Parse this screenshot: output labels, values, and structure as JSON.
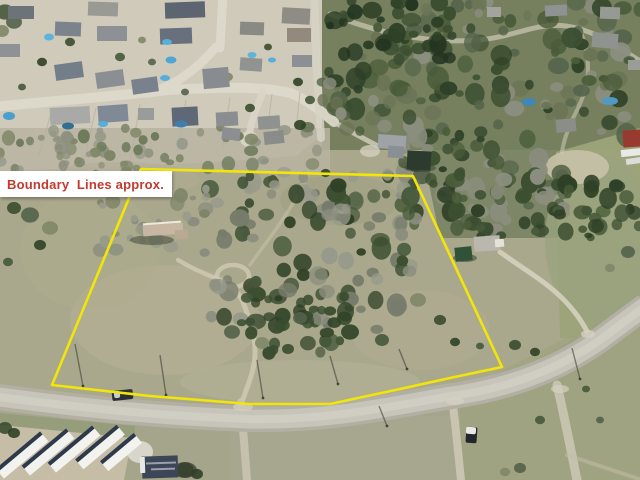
{
  "annotation": {
    "label": "Boundary  Lines approx.",
    "text_color": "#c43a2f",
    "bg_color": "#ffffff"
  },
  "boundary": {
    "color": "#f2e50a",
    "width": 2.6,
    "points": "141,169 413,176 502,367 450,378 400,389 330,404 250,404 150,396 52,385"
  },
  "scene": {
    "bases": [
      {
        "type": "rect",
        "x": 0,
        "y": 0,
        "w": 640,
        "h": 480,
        "f": "#aaa88c"
      },
      {
        "type": "poly",
        "pts": "0,0 322,0 322,135 296,156 200,163 80,168 0,171",
        "f": "#cfcaba"
      },
      {
        "type": "rect",
        "x": 322,
        "y": 0,
        "w": 318,
        "h": 150,
        "f": "#76805f"
      },
      {
        "type": "poly",
        "pts": "420,140 570,140 570,238 440,238",
        "f": "#76805f",
        "o": 0.85
      },
      {
        "type": "poly",
        "pts": "556,152 640,128 640,338 560,338",
        "f": "#9ca379",
        "o": 0.95
      },
      {
        "type": "poly",
        "pts": "0,412 240,428 460,402 640,302 640,480 0,480",
        "f": "#a5a58c"
      },
      {
        "type": "rect",
        "x": 0,
        "y": 128,
        "w": 330,
        "h": 44,
        "f": "#b8b4a0",
        "o": 0.85
      },
      {
        "type": "poly",
        "pts": "230,416 460,416 460,480 230,480",
        "f": "#a8a791",
        "o": 0.6
      },
      {
        "type": "poly",
        "pts": "460,392 640,300 640,480 460,480",
        "f": "#9ba279",
        "o": 0.55
      },
      {
        "type": "poly",
        "pts": "0,413 135,426 135,438 0,425",
        "f": "#959c79",
        "o": 0.9
      },
      {
        "type": "poly",
        "pts": "0,425 132,438 124,480 0,480",
        "f": "#c5bda6"
      }
    ],
    "patches": [
      {
        "cx": 165,
        "cy": 320,
        "rx": 95,
        "ry": 55,
        "f": "#b6b298",
        "o": 0.5
      },
      {
        "cx": 420,
        "cy": 330,
        "rx": 70,
        "ry": 40,
        "f": "#b2ae92",
        "o": 0.45
      },
      {
        "cx": 300,
        "cy": 382,
        "rx": 120,
        "ry": 22,
        "f": "#b6b39a",
        "o": 0.4
      },
      {
        "cx": 90,
        "cy": 250,
        "rx": 70,
        "ry": 60,
        "f": "#aeab8c",
        "o": 0.5
      },
      {
        "cx": 600,
        "cy": 240,
        "rx": 55,
        "ry": 85,
        "f": "#9aa37e",
        "o": 0.8
      },
      {
        "cx": 577,
        "cy": 167,
        "rx": 32,
        "ry": 17,
        "f": "#c8c2a8",
        "o": 0.9
      },
      {
        "cx": 340,
        "cy": 200,
        "rx": 60,
        "ry": 25,
        "f": "#9a9a80",
        "o": 0.4
      },
      {
        "cx": 120,
        "cy": 180,
        "rx": 80,
        "ry": 18,
        "f": "#b0ac94",
        "o": 0.5
      }
    ],
    "streets": [
      {
        "d": "M -6 107 C 60 100 120 96 168 90 C 225 87 262 86 290 93 C 306 99 320 110 334 122",
        "w": 10,
        "c": "#dcd8ca",
        "o": 0.95
      },
      {
        "d": "M 150 93 C 178 84 200 66 216 47",
        "w": 9,
        "c": "#dcd8ca",
        "o": 0.95
      },
      {
        "d": "M 220 48 L 223 -6",
        "w": 9,
        "c": "#dcd8ca",
        "o": 0.95
      },
      {
        "d": "M 263 91 C 258 106 252 116 250 131",
        "w": 7,
        "c": "#d9d5c7",
        "o": 0.9
      },
      {
        "d": "M 314 -6 L 317 70 L 321 138",
        "w": 8,
        "c": "#d6d2c4",
        "o": 0.85
      },
      {
        "d": "M 330 14 C 380 34 432 44 478 40 C 515 37 536 22 566 26 C 596 30 618 48 642 62",
        "w": 5,
        "c": "#cfcab6",
        "o": 0.7
      },
      {
        "d": "M 580 30 C 590 55 592 80 578 108 C 570 124 564 138 562 152",
        "w": 4,
        "c": "#cfcab6",
        "o": 0.55
      }
    ],
    "lot_lines": [
      [
        52,
        110,
        38,
        158
      ],
      [
        96,
        108,
        84,
        160
      ],
      [
        140,
        104,
        130,
        162
      ],
      [
        186,
        100,
        176,
        163
      ],
      [
        230,
        97,
        222,
        150
      ],
      [
        272,
        94,
        266,
        140
      ],
      [
        300,
        92,
        296,
        130
      ]
    ],
    "paths": [
      {
        "d": "M 330 120 C 345 128 362 138 378 146",
        "w": 5,
        "c": "#d4cfbd",
        "o": 0.8
      },
      {
        "d": "M 500 252 C 522 268 546 282 562 298 C 576 312 582 322 588 333",
        "w": 5,
        "c": "#d8d3c1",
        "o": 0.85
      },
      {
        "d": "M 243 399 C 250 380 256 365 255 349 C 254 330 248 316 243 302 C 238 290 228 283 215 278",
        "w": 5,
        "c": "#cfc9b2",
        "o": 0.85
      },
      {
        "d": "M 215 278 C 200 272 188 266 178 260",
        "w": 4.5,
        "c": "#cfc9b2",
        "o": 0.8
      },
      {
        "d": "M 250 265 C 262 248 280 225 292 205 C 300 192 305 182 308 173",
        "w": 3.5,
        "c": "#c9c3ac",
        "o": 0.5
      },
      {
        "d": "M 241 402 L 247 480",
        "w": 8,
        "c": "#c9c4b0",
        "o": 0.9
      },
      {
        "d": "M 452 398 C 455 420 458 450 461 480",
        "w": 8,
        "c": "#ccc8b4",
        "o": 0.9
      },
      {
        "d": "M 557 385 C 563 410 570 445 577 480",
        "w": 9,
        "c": "#c9c5b1",
        "o": 0.9
      },
      {
        "d": "M 567 455 L 642 480",
        "w": 4,
        "c": "#c2bda6",
        "o": 0.55
      }
    ],
    "loop": {
      "cx": 233,
      "cy": 276,
      "rx": 16,
      "ry": 11,
      "w": 4.5,
      "c": "#cfc9b2",
      "o": 0.8
    },
    "road": {
      "d": "M -8 396 C 80 408 160 416 248 419 C 330 421 390 406 452 396 C 510 388 560 368 600 340 C 620 325 632 316 646 306",
      "outer": "#b3afa3",
      "inner": "#c7c4b9",
      "stripe": "#d6d3c8",
      "wo": 26,
      "wi": 19,
      "ws": 8
    },
    "pads": [
      [
        249,
        139,
        9,
        8,
        "#d9d5c7",
        0.9
      ],
      [
        140,
        452,
        13,
        11,
        "#dedbd0",
        0.9
      ],
      [
        243,
        407,
        10,
        4,
        "#d6d2c2",
        0.7
      ],
      [
        455,
        401,
        9,
        4,
        "#d6d2c2",
        0.7
      ],
      [
        560,
        389,
        9,
        4,
        "#d4d0c0",
        0.7
      ],
      [
        588,
        334,
        7,
        4,
        "#d8d4c4",
        0.7
      ],
      [
        370,
        151,
        10,
        6,
        "#d8d3c0",
        0.75
      ]
    ],
    "storage_slats": [
      [
        22,
        455,
        58
      ],
      [
        48,
        452,
        58
      ],
      [
        74,
        449,
        58
      ],
      [
        100,
        447,
        54
      ],
      [
        121,
        452,
        44
      ]
    ],
    "storage_colors": {
      "roof": "#f2f2ee",
      "stripe": "#2e3a4a"
    },
    "clusters": [
      {
        "x": 322,
        "y": 0,
        "w": 318,
        "h": 138,
        "n": 150,
        "seed": 7,
        "rmin": 4,
        "rmax": 11,
        "pal": [
          "#3c4f31",
          "#2e4026",
          "#4a5c3a",
          "#8b8e7e",
          "#55644a",
          "#6b7456"
        ]
      },
      {
        "x": 400,
        "y": 130,
        "w": 165,
        "h": 100,
        "n": 70,
        "seed": 11,
        "rmin": 4,
        "rmax": 10,
        "pal": [
          "#3c4f31",
          "#2e4026",
          "#4a5c3a",
          "#8b8e7e",
          "#55644a"
        ]
      },
      {
        "x": 330,
        "y": 0,
        "w": 120,
        "h": 60,
        "n": 30,
        "seed": 5,
        "rmin": 4,
        "rmax": 9,
        "pal": [
          "#2e4026",
          "#3c4f31",
          "#243420"
        ]
      },
      {
        "x": 210,
        "y": 172,
        "w": 210,
        "h": 160,
        "n": 120,
        "seed": 13,
        "rmin": 4,
        "rmax": 10,
        "pal": [
          "#8b8e7e",
          "#3c4f31",
          "#979a8a",
          "#46583a",
          "#2f4126",
          "#767b6a"
        ]
      },
      {
        "x": 250,
        "y": 295,
        "w": 100,
        "h": 60,
        "n": 28,
        "seed": 17,
        "rmin": 4,
        "rmax": 9,
        "pal": [
          "#2f4126",
          "#3a4c2f",
          "#46583a"
        ]
      },
      {
        "x": 0,
        "y": 126,
        "w": 320,
        "h": 44,
        "n": 60,
        "seed": 19,
        "rmin": 3,
        "rmax": 7,
        "pal": [
          "#8f9180",
          "#7f8668",
          "#6e7a5c",
          "#97998a"
        ]
      },
      {
        "x": 100,
        "y": 188,
        "w": 110,
        "h": 65,
        "n": 26,
        "seed": 23,
        "rmin": 3,
        "rmax": 8,
        "pal": [
          "#8b8e7e",
          "#979a8a",
          "#7f8668"
        ]
      },
      {
        "x": 553,
        "y": 183,
        "w": 87,
        "h": 55,
        "n": 30,
        "seed": 29,
        "rmin": 4,
        "rmax": 9,
        "pal": [
          "#3c4f31",
          "#2e4026",
          "#4a5c3a"
        ]
      },
      {
        "x": 455,
        "y": 168,
        "w": 90,
        "h": 70,
        "n": 30,
        "seed": 31,
        "rmin": 4,
        "rmax": 9,
        "pal": [
          "#3c4f31",
          "#4a5c3a",
          "#8b8e7e",
          "#2e4026"
        ]
      },
      {
        "x": 60,
        "y": 150,
        "w": 100,
        "h": 40,
        "n": 18,
        "seed": 37,
        "rmin": 3,
        "rmax": 6,
        "pal": [
          "#8f9180",
          "#7f8668"
        ]
      }
    ],
    "single_trees": [
      [
        70,
        42,
        5
      ],
      [
        42,
        62,
        5
      ],
      [
        120,
        57,
        5
      ],
      [
        152,
        62,
        4
      ],
      [
        228,
        77,
        5
      ],
      [
        268,
        47,
        4
      ],
      [
        298,
        82,
        5
      ],
      [
        22,
        87,
        4
      ],
      [
        185,
        92,
        4
      ],
      [
        142,
        40,
        4
      ],
      [
        250,
        108,
        5
      ],
      [
        300,
        125,
        6
      ],
      [
        310,
        100,
        5
      ],
      [
        30,
        215,
        9
      ],
      [
        50,
        228,
        8
      ],
      [
        14,
        208,
        7
      ],
      [
        40,
        245,
        6
      ],
      [
        8,
        262,
        5
      ],
      [
        232,
        332,
        8
      ],
      [
        262,
        343,
        7
      ],
      [
        288,
        349,
        6
      ],
      [
        350,
        332,
        9
      ],
      [
        382,
        340,
        7
      ],
      [
        300,
        318,
        7
      ],
      [
        418,
        300,
        8
      ],
      [
        440,
        320,
        6
      ],
      [
        455,
        342,
        5
      ],
      [
        480,
        346,
        4
      ],
      [
        628,
        252,
        7
      ],
      [
        610,
        268,
        5
      ],
      [
        515,
        345,
        6
      ],
      [
        535,
        352,
        5
      ],
      [
        540,
        420,
        5
      ],
      [
        520,
        468,
        6
      ],
      [
        505,
        472,
        5
      ],
      [
        5,
        428,
        7
      ],
      [
        14,
        433,
        6
      ],
      [
        5,
        12,
        9
      ],
      [
        14,
        22,
        8
      ],
      [
        2,
        31,
        7
      ],
      [
        185,
        470,
        9
      ],
      [
        197,
        474,
        6
      ],
      [
        586,
        389,
        4
      ],
      [
        600,
        420,
        4
      ]
    ],
    "tree_palette": [
      "#3a4c2f",
      "#2f4126",
      "#46583a",
      "#53624a",
      "#7f8668"
    ],
    "shadows": [
      {
        "cx": 152,
        "cy": 240,
        "rx": 22,
        "ry": 5,
        "f": "#39402f",
        "o": 0.5
      },
      {
        "cx": 185,
        "cy": 470,
        "rx": 12,
        "ry": 8,
        "f": "#343c2c",
        "o": 0.7
      },
      {
        "cx": 420,
        "cy": 168,
        "rx": 16,
        "ry": 4,
        "f": "#333b2b",
        "o": 0.5
      },
      {
        "cx": 465,
        "cy": 258,
        "rx": 12,
        "ry": 4,
        "f": "#2f372a",
        "o": 0.5
      }
    ],
    "houses": [
      [
        8,
        6,
        26,
        13,
        "#6d7479",
        0
      ],
      [
        88,
        2,
        30,
        14,
        "#9a9a94",
        2
      ],
      [
        165,
        2,
        40,
        16,
        "#5d6571",
        -2
      ],
      [
        282,
        8,
        28,
        16,
        "#8e8c84",
        3
      ],
      [
        55,
        22,
        26,
        14,
        "#7b838c",
        2
      ],
      [
        97,
        26,
        30,
        15,
        "#8d9094",
        0
      ],
      [
        160,
        28,
        32,
        16,
        "#67707c",
        -2
      ],
      [
        240,
        22,
        24,
        13,
        "#8a8a84",
        2
      ],
      [
        287,
        28,
        24,
        14,
        "#93897c",
        0
      ],
      [
        0,
        44,
        20,
        13,
        "#8f9294",
        0
      ],
      [
        55,
        63,
        28,
        16,
        "#747e88",
        -8
      ],
      [
        96,
        71,
        28,
        16,
        "#8b8e92",
        -8
      ],
      [
        132,
        78,
        26,
        15,
        "#79828c",
        -8
      ],
      [
        203,
        68,
        26,
        20,
        "#888b90",
        -5
      ],
      [
        292,
        55,
        20,
        12,
        "#8c9094",
        0
      ],
      [
        240,
        58,
        22,
        13,
        "#909390",
        4
      ],
      [
        50,
        107,
        40,
        17,
        "#a9aaa8",
        -3
      ],
      [
        98,
        105,
        30,
        17,
        "#7f8a96",
        -4
      ],
      [
        138,
        108,
        16,
        12,
        "#9a9c9c",
        0
      ],
      [
        172,
        107,
        26,
        19,
        "#5f6876",
        -3
      ],
      [
        216,
        112,
        22,
        14,
        "#8b8e90",
        -3
      ],
      [
        258,
        116,
        22,
        13,
        "#90928f",
        -4
      ],
      [
        222,
        128,
        18,
        12,
        "#8c8f92",
        6
      ],
      [
        264,
        131,
        20,
        13,
        "#898c88",
        -6
      ],
      [
        378,
        135,
        28,
        14,
        "#9fa3a8",
        4
      ],
      [
        388,
        146,
        16,
        12,
        "#8a8f95",
        4
      ],
      [
        407,
        151,
        24,
        19,
        "#2c3b2e",
        3
      ],
      [
        474,
        236,
        26,
        15,
        "#b9b7ae",
        -4
      ],
      [
        495,
        239,
        9,
        8,
        "#e5e2da",
        -4
      ],
      [
        455,
        247,
        17,
        14,
        "#2f5238",
        -6
      ],
      [
        487,
        7,
        14,
        10,
        "#a3a49e",
        0
      ],
      [
        545,
        5,
        22,
        11,
        "#8f9292",
        -3
      ],
      [
        600,
        7,
        20,
        12,
        "#979994",
        2
      ],
      [
        592,
        33,
        26,
        15,
        "#8f938f",
        5
      ],
      [
        556,
        119,
        20,
        13,
        "#8a8e88",
        -5
      ],
      [
        628,
        60,
        14,
        10,
        "#9a9c96",
        0
      ],
      [
        623,
        130,
        20,
        17,
        "#993a30",
        -4
      ],
      [
        621,
        149,
        22,
        7,
        "#e9e9e6",
        -6
      ],
      [
        626,
        158,
        15,
        6,
        "#dcdcd8",
        -8
      ],
      [
        142,
        456,
        36,
        22,
        "#3c4656",
        -2
      ],
      [
        146,
        462,
        30,
        2,
        "#99a0ac",
        -2
      ],
      [
        151,
        468,
        24,
        2,
        "#99a0ac",
        -2
      ],
      [
        140,
        457,
        5,
        16,
        "#e8e8e4",
        -2
      ],
      [
        143,
        224,
        40,
        11,
        "#c7b6a2",
        -4
      ],
      [
        175,
        230,
        13,
        9,
        "#b9a892",
        -4
      ],
      [
        143,
        222,
        38,
        2,
        "#efe9dd",
        -4
      ]
    ],
    "pools": [
      [
        49,
        37,
        5,
        3.5,
        "#5fb4dd"
      ],
      [
        167,
        42,
        5,
        3,
        "#57aeda"
      ],
      [
        171,
        60,
        5.5,
        3.5,
        "#4fa6d4"
      ],
      [
        165,
        78,
        5,
        3,
        "#57aeda"
      ],
      [
        252,
        55,
        4.5,
        3,
        "#5fb4dd"
      ],
      [
        272,
        60,
        4,
        2.5,
        "#57aeda"
      ],
      [
        9,
        116,
        6,
        4,
        "#4a9fcc"
      ],
      [
        103,
        124,
        5,
        3,
        "#57aed8"
      ],
      [
        181,
        124,
        6.5,
        3.5,
        "#3f7fae"
      ],
      [
        68,
        126,
        6,
        3.5,
        "#2f7090"
      ],
      [
        529,
        102,
        7,
        4,
        "#3f87b5"
      ],
      [
        610,
        101,
        8,
        4,
        "#4f9ac5"
      ]
    ],
    "vehicles": [
      [
        112,
        390,
        21,
        10,
        "#2b2e33",
        -6
      ],
      [
        114,
        391,
        6,
        7,
        "#c7ccd2",
        -6
      ],
      [
        466,
        427,
        11,
        16,
        "#23262b",
        4
      ],
      [
        466,
        427,
        10,
        7,
        "#e8e8e6",
        4
      ]
    ],
    "poles": [
      [
        75,
        344,
        83,
        386
      ],
      [
        160,
        355,
        166,
        395
      ],
      [
        257,
        360,
        263,
        398
      ],
      [
        330,
        356,
        338,
        384
      ],
      [
        399,
        349,
        407,
        369
      ],
      [
        572,
        348,
        580,
        379
      ],
      [
        379,
        406,
        387,
        426
      ]
    ],
    "pole_color": "#3f4135"
  }
}
